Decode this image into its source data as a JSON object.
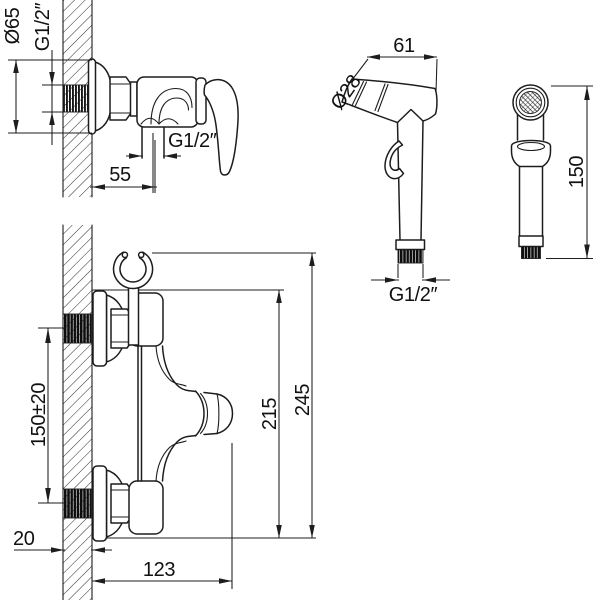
{
  "drawing": {
    "colors": {
      "background": "#ffffff",
      "line": "#1d1d1d"
    },
    "views": {
      "mixer_side": {
        "dims": {
          "flange_diameter": "Ø65",
          "inlet_thread": "G1/2″",
          "outlet_thread": "G1/2″",
          "outlet_offset": "55"
        }
      },
      "sprayer_side": {
        "dims": {
          "head_length": "61",
          "head_diameter": "Ø28",
          "connector_thread": "G1/2″"
        }
      },
      "sprayer_front": {
        "dims": {
          "height": "150"
        }
      },
      "mixer_front": {
        "dims": {
          "inlet_spacing": "150±20",
          "wall_thickness": "20",
          "spout_reach": "123",
          "body_height": "215",
          "total_height": "245"
        }
      }
    }
  }
}
